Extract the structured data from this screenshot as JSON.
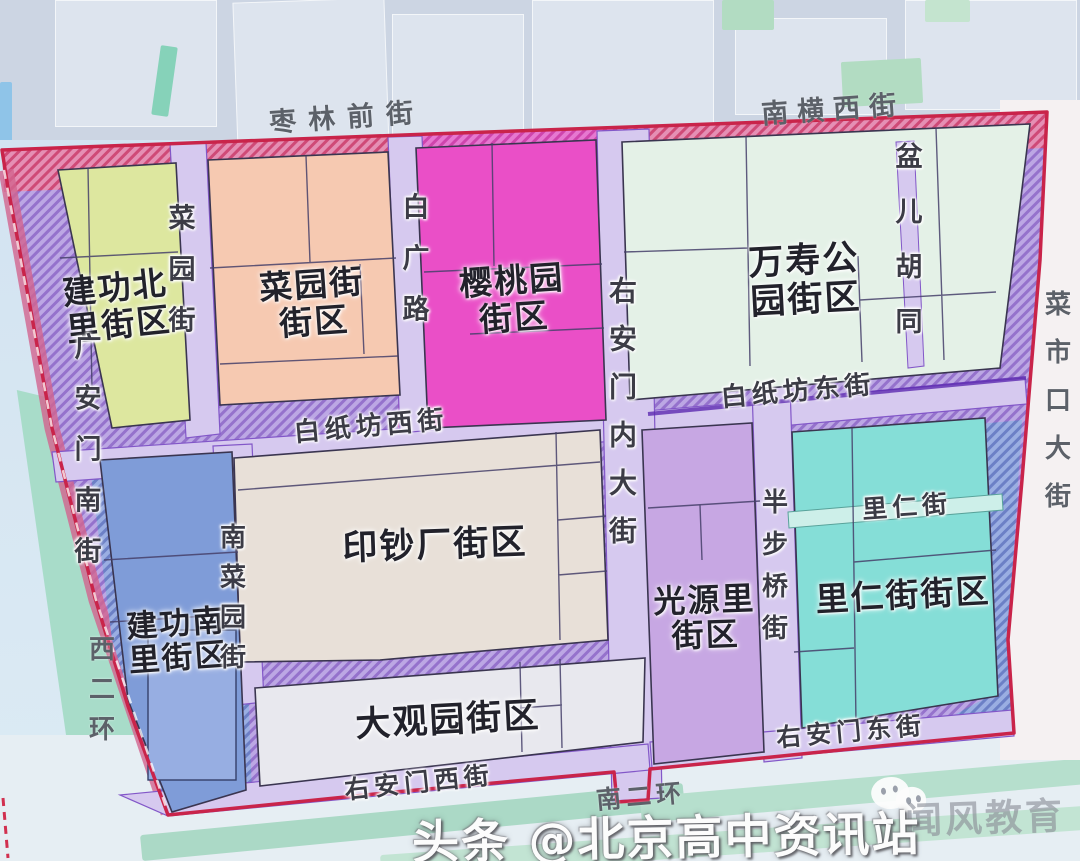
{
  "page": {
    "kind": "district-planning-map-photo",
    "area": "北京 白纸坊一带街区划分图"
  },
  "map": {
    "boundary_color": "#c9244a",
    "hatch_color": "#9572cc",
    "districts": [
      {
        "name": "建功北里街区",
        "line1": "建功北",
        "line2": "里街区",
        "color": "#dde79f"
      },
      {
        "name": "菜园街街区",
        "line1": "菜园街",
        "line2": "街区",
        "color": "#f6c9b1"
      },
      {
        "name": "樱桃园街区",
        "line1": "樱桃园",
        "line2": "街区",
        "color": "#ea4fc7"
      },
      {
        "name": "万寿公园街区",
        "line1": "万寿公",
        "line2": "园街区",
        "color": "#e4f1e7"
      },
      {
        "name": "印钞厂街区",
        "line1": "印钞厂街区",
        "line2": "",
        "color": "#e8e0d8"
      },
      {
        "name": "建功南里街区",
        "line1": "建功南",
        "line2": "里街区",
        "color": "#7f9cd8"
      },
      {
        "name": "大观园街区",
        "line1": "大观园街区",
        "line2": "",
        "color": "#e8e8ee"
      },
      {
        "name": "光源里街区",
        "line1": "光源里",
        "line2": "街区",
        "color": "#c7a7e3"
      },
      {
        "name": "里仁街街区",
        "line1": "里仁街街区",
        "line2": "",
        "color": "#85ded7"
      }
    ],
    "streets": {
      "zaolin_qian_jie": "枣林前街",
      "nanheng_xi_jie": "南横西街",
      "baizhifang_xi_jie": "白纸坊西街",
      "baizhifang_dong_jie": "白纸坊东街",
      "liren_jie": "里仁街",
      "youanmen_dong_jie": "右安门东街",
      "youanmen_xi_jie": "右安门西街",
      "nan_er_huan": "南二环",
      "caiyuan_jie": "菜园街",
      "baiguang_lu": "白广路",
      "youanmen_nei_dajie": "右安门内大街",
      "pener_hutong": "盆儿胡同",
      "caishikou_dajie": "菜市口大街",
      "guanganmen_nan_jie": "广安门南街",
      "xi_er_huan": "西二环",
      "nancaiyuan_jie": "南菜园街",
      "banbuqiao_jie": "半步桥街"
    }
  },
  "watermark": {
    "publisher": "头条 @北京高中资讯站",
    "faint_text": "闻风教育",
    "icon": "wechat-chat-bubbles-icon"
  }
}
